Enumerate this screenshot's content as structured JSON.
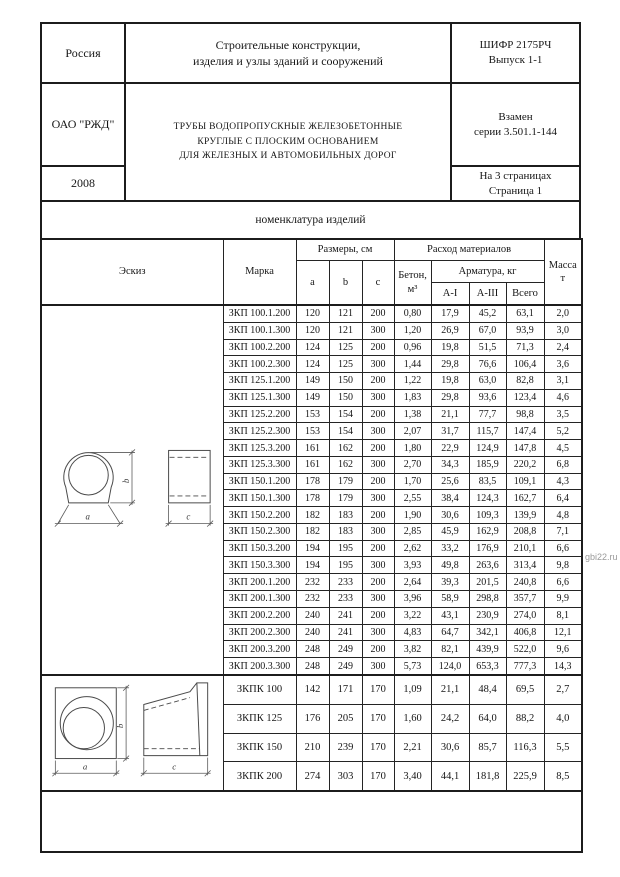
{
  "header": {
    "country": "Россия",
    "org": "ОАО \"РЖД\"",
    "year": "2008",
    "series_title_line1": "Строительные конструкции,",
    "series_title_line2": "изделия и узлы зданий и сооружений",
    "cipher_line1": "ШИФР 2175РЧ",
    "cipher_line2": "Выпуск 1-1",
    "product_title_line1": "ТРУБЫ ВОДОПРОПУСКНЫЕ ЖЕЛЕЗОБЕТОННЫЕ",
    "product_title_line2": "КРУГЛЫЕ С ПЛОСКИМ ОСНОВАНИЕМ",
    "product_title_line3": "ДЛЯ ЖЕЛЕЗНЫХ И АВТОМОБИЛЬНЫХ ДОРОГ",
    "replaces_line1": "Взамен",
    "replaces_line2": "серии 3.501.1-144",
    "pages_line1": "На 3 страницах",
    "pages_line2": "Страница 1"
  },
  "section_title": "номенклатура изделий",
  "table": {
    "headers": {
      "sketch": "Эскиз",
      "mark": "Марка",
      "dimensions": "Размеры, см",
      "dim_a": "a",
      "dim_b": "b",
      "dim_c": "c",
      "concrete_line1": "Бетон,",
      "concrete_line2": "м³",
      "materials": "Расход материалов",
      "rebar": "Арматура, кг",
      "rebar_ai": "A-I",
      "rebar_aiii": "A-III",
      "rebar_total": "Всего",
      "mass_line1": "Масса",
      "mass_line2": "т"
    },
    "zkp_rows": [
      {
        "mark": "ЗКП 100.1.200",
        "values": [
          "120",
          "121",
          "200",
          "0,80",
          "17,9",
          "45,2",
          "63,1",
          "2,0"
        ]
      },
      {
        "mark": "ЗКП 100.1.300",
        "values": [
          "120",
          "121",
          "300",
          "1,20",
          "26,9",
          "67,0",
          "93,9",
          "3,0"
        ]
      },
      {
        "mark": "ЗКП 100.2.200",
        "values": [
          "124",
          "125",
          "200",
          "0,96",
          "19,8",
          "51,5",
          "71,3",
          "2,4"
        ]
      },
      {
        "mark": "ЗКП 100.2.300",
        "values": [
          "124",
          "125",
          "300",
          "1,44",
          "29,8",
          "76,6",
          "106,4",
          "3,6"
        ]
      },
      {
        "mark": "ЗКП 125.1.200",
        "values": [
          "149",
          "150",
          "200",
          "1,22",
          "19,8",
          "63,0",
          "82,8",
          "3,1"
        ]
      },
      {
        "mark": "ЗКП 125.1.300",
        "values": [
          "149",
          "150",
          "300",
          "1,83",
          "29,8",
          "93,6",
          "123,4",
          "4,6"
        ]
      },
      {
        "mark": "ЗКП 125.2.200",
        "values": [
          "153",
          "154",
          "200",
          "1,38",
          "21,1",
          "77,7",
          "98,8",
          "3,5"
        ]
      },
      {
        "mark": "ЗКП 125.2.300",
        "values": [
          "153",
          "154",
          "300",
          "2,07",
          "31,7",
          "115,7",
          "147,4",
          "5,2"
        ]
      },
      {
        "mark": "ЗКП 125.3.200",
        "values": [
          "161",
          "162",
          "200",
          "1,80",
          "22,9",
          "124,9",
          "147,8",
          "4,5"
        ]
      },
      {
        "mark": "ЗКП 125.3.300",
        "values": [
          "161",
          "162",
          "300",
          "2,70",
          "34,3",
          "185,9",
          "220,2",
          "6,8"
        ]
      },
      {
        "mark": "ЗКП 150.1.200",
        "values": [
          "178",
          "179",
          "200",
          "1,70",
          "25,6",
          "83,5",
          "109,1",
          "4,3"
        ]
      },
      {
        "mark": "ЗКП 150.1.300",
        "values": [
          "178",
          "179",
          "300",
          "2,55",
          "38,4",
          "124,3",
          "162,7",
          "6,4"
        ]
      },
      {
        "mark": "ЗКП 150.2.200",
        "values": [
          "182",
          "183",
          "200",
          "1,90",
          "30,6",
          "109,3",
          "139,9",
          "4,8"
        ]
      },
      {
        "mark": "ЗКП 150.2.300",
        "values": [
          "182",
          "183",
          "300",
          "2,85",
          "45,9",
          "162,9",
          "208,8",
          "7,1"
        ]
      },
      {
        "mark": "ЗКП 150.3.200",
        "values": [
          "194",
          "195",
          "200",
          "2,62",
          "33,2",
          "176,9",
          "210,1",
          "6,6"
        ]
      },
      {
        "mark": "ЗКП 150.3.300",
        "values": [
          "194",
          "195",
          "300",
          "3,93",
          "49,8",
          "263,6",
          "313,4",
          "9,8"
        ]
      },
      {
        "mark": "ЗКП 200.1.200",
        "values": [
          "232",
          "233",
          "200",
          "2,64",
          "39,3",
          "201,5",
          "240,8",
          "6,6"
        ]
      },
      {
        "mark": "ЗКП 200.1.300",
        "values": [
          "232",
          "233",
          "300",
          "3,96",
          "58,9",
          "298,8",
          "357,7",
          "9,9"
        ]
      },
      {
        "mark": "ЗКП 200.2.200",
        "values": [
          "240",
          "241",
          "200",
          "3,22",
          "43,1",
          "230,9",
          "274,0",
          "8,1"
        ]
      },
      {
        "mark": "ЗКП 200.2.300",
        "values": [
          "240",
          "241",
          "300",
          "4,83",
          "64,7",
          "342,1",
          "406,8",
          "12,1"
        ]
      },
      {
        "mark": "ЗКП 200.3.200",
        "values": [
          "248",
          "249",
          "200",
          "3,82",
          "82,1",
          "439,9",
          "522,0",
          "9,6"
        ]
      },
      {
        "mark": "ЗКП 200.3.300",
        "values": [
          "248",
          "249",
          "300",
          "5,73",
          "124,0",
          "653,3",
          "777,3",
          "14,3"
        ]
      }
    ],
    "zkpk_rows": [
      {
        "mark": "ЗКПК 100",
        "values": [
          "142",
          "171",
          "170",
          "1,09",
          "21,1",
          "48,4",
          "69,5",
          "2,7"
        ]
      },
      {
        "mark": "ЗКПК 125",
        "values": [
          "176",
          "205",
          "170",
          "1,60",
          "24,2",
          "64,0",
          "88,2",
          "4,0"
        ]
      },
      {
        "mark": "ЗКПК 150",
        "values": [
          "210",
          "239",
          "170",
          "2,21",
          "30,6",
          "85,7",
          "116,3",
          "5,5"
        ]
      },
      {
        "mark": "ЗКПК 200",
        "values": [
          "274",
          "303",
          "170",
          "3,40",
          "44,1",
          "181,8",
          "225,9",
          "8,5"
        ]
      }
    ]
  },
  "sketch_labels": {
    "a": "a",
    "b": "b",
    "c": "c"
  },
  "watermark": "gbi22.ru"
}
